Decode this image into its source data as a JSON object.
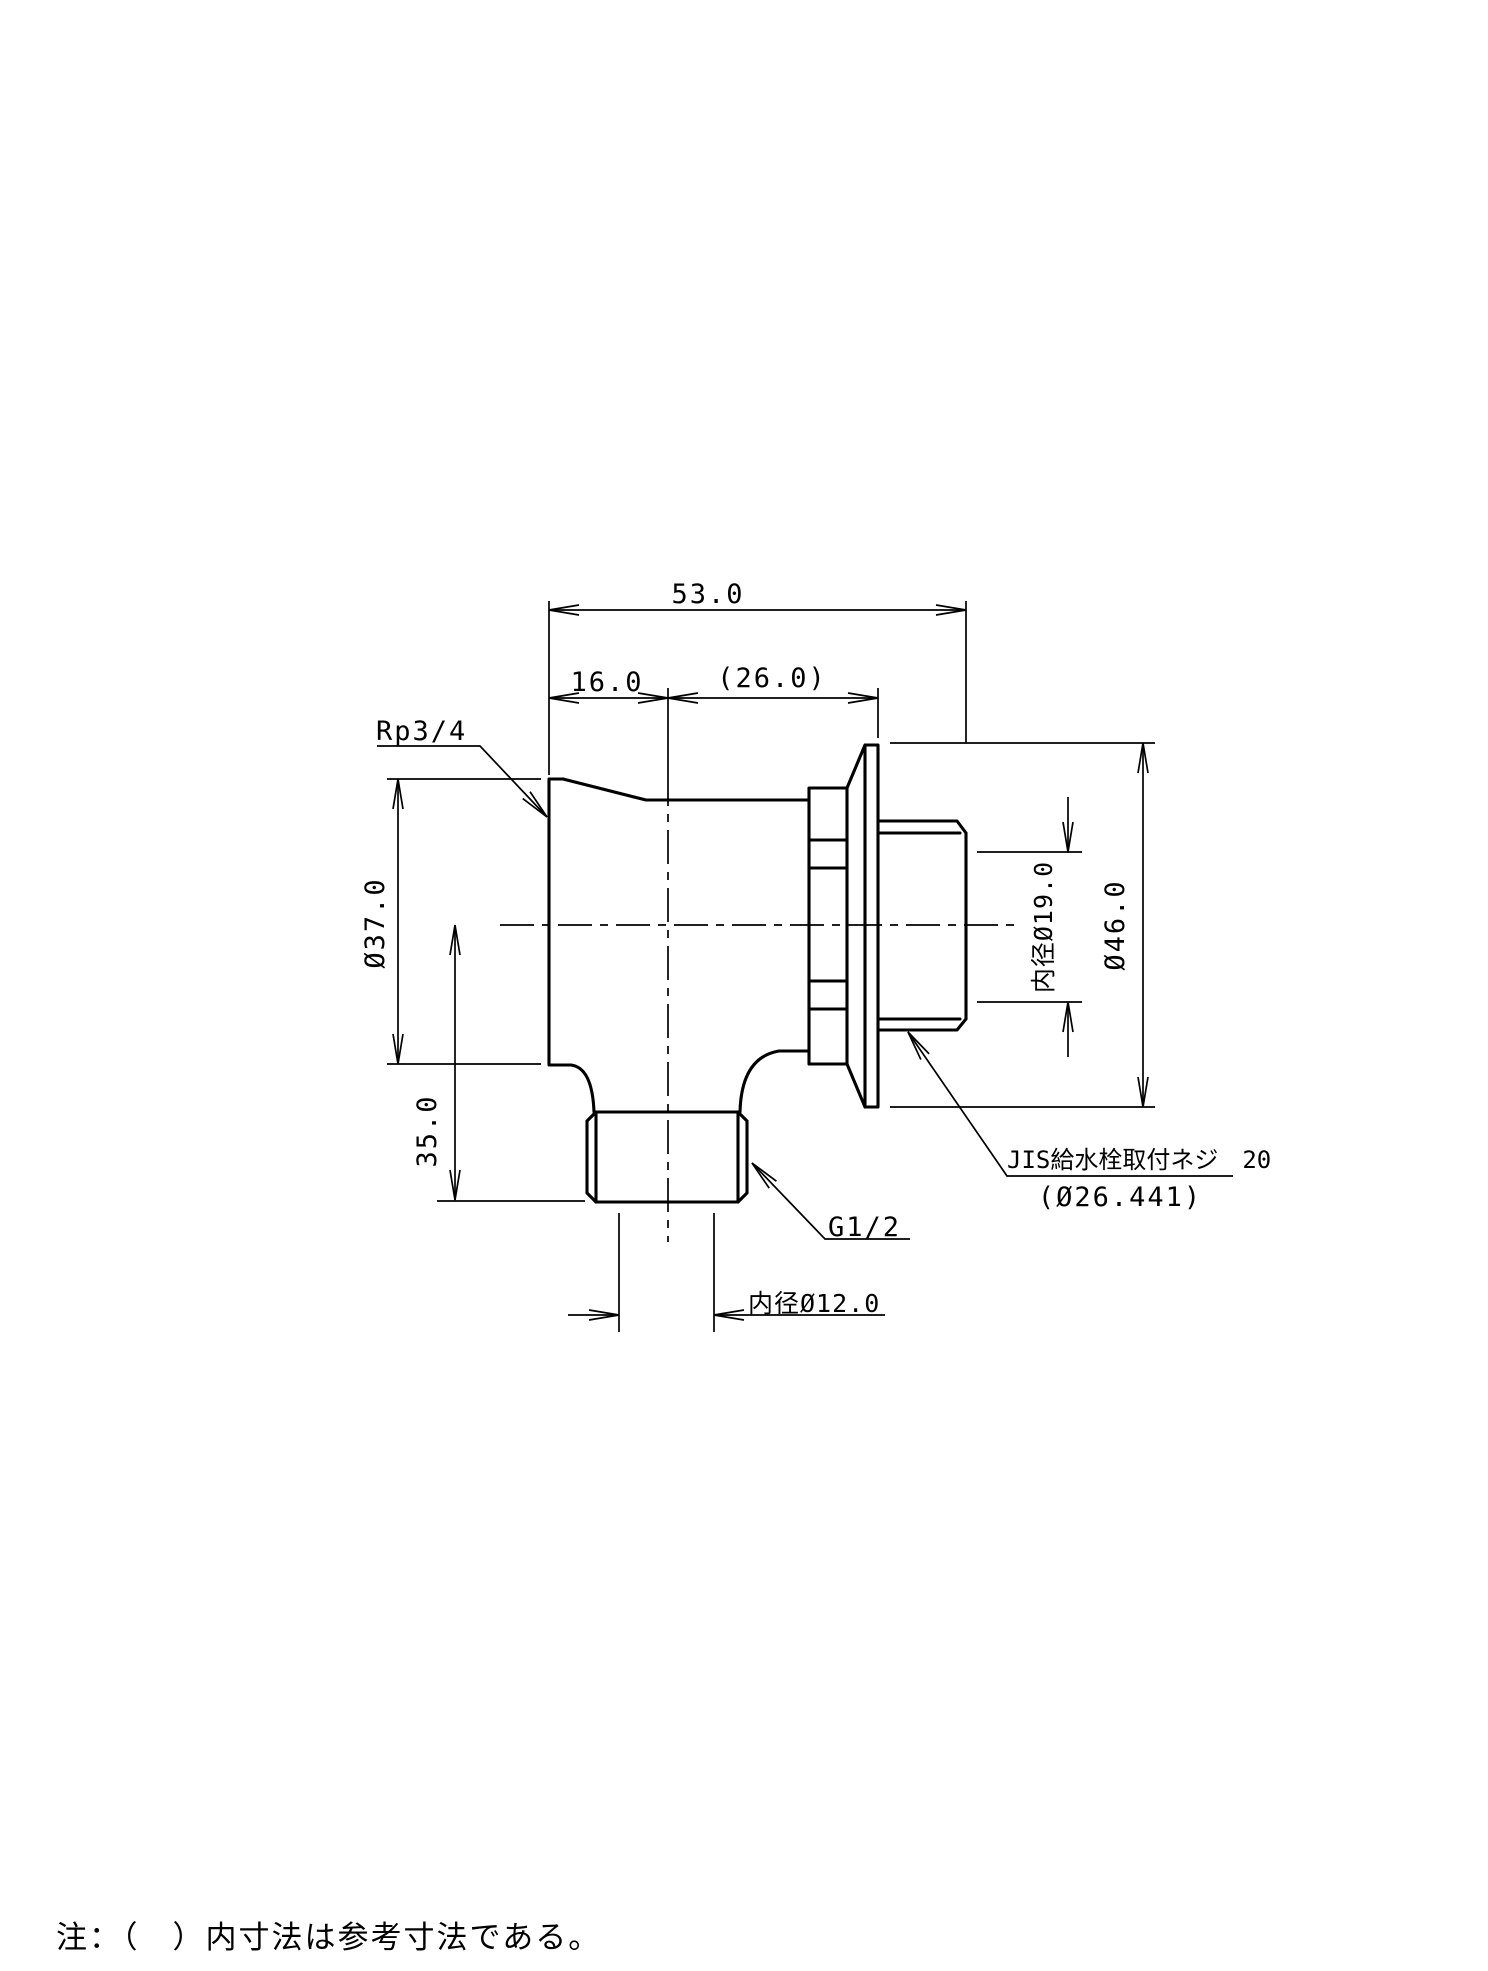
{
  "drawing": {
    "title_note": "注：（　）内寸法は参考寸法である。",
    "colors": {
      "line": "#000000",
      "background": "#ffffff"
    },
    "labels": {
      "thread_body": "Rp3/4",
      "thread_bottom": "G1/2",
      "thread_right_line1": "JIS給水栓取付ネジ　20",
      "thread_right_line2": "(Ø26.441)"
    },
    "dimensions": {
      "overall_width": "53.0",
      "left_to_axis": "16.0",
      "axis_to_face_ref": "(26.0)",
      "body_diameter": "Ø37.0",
      "axis_to_bottom": "35.0",
      "inner_diameter_right": "内径Ø19.0",
      "flange_diameter": "Ø46.0",
      "inner_diameter_bottom": "内径Ø12.0"
    }
  }
}
